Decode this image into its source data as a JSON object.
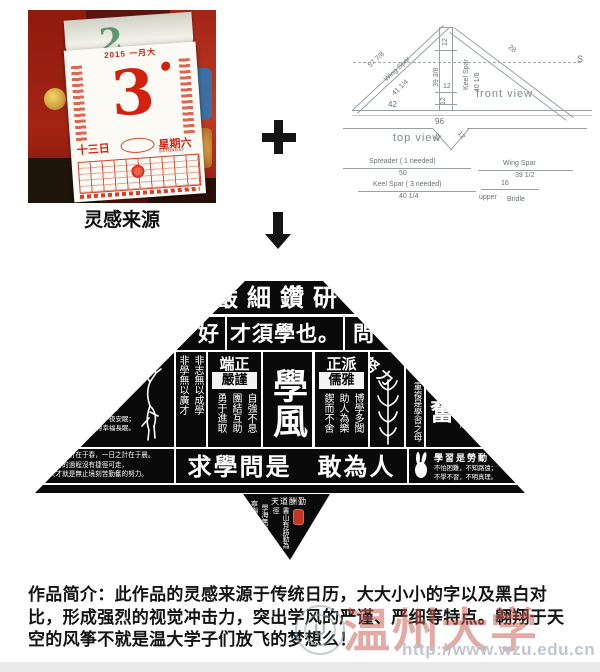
{
  "inspiration": {
    "label": "灵感来源",
    "calendar": {
      "prev_number": "2",
      "year": "2015",
      "month": "一月大",
      "day": "3",
      "day_cn": "十三日",
      "weekday_cn": "星期六",
      "weekday_en": "SATURDAY"
    }
  },
  "diagram": {
    "front_view_label": "front view",
    "top_view_label": "top view",
    "dims": {
      "wing_outer": "57 7/8",
      "wing_spar": "Wing Spar",
      "wing_inner": "41 1/4",
      "right_spar": "28",
      "spreader_end": "S",
      "keel_seg_top": "12",
      "keel_left": "39 3/8",
      "keel_label": "Keel Spar",
      "keel_right": "40 1/8",
      "keel_seg_mid": "12",
      "keel_seg_low": "12",
      "base_left": "42",
      "base_full": "96",
      "tv_left": "12",
      "tv_right": "12"
    },
    "parts": {
      "spreader_name": "Spreader ( 1 needed)",
      "spreader_len": "50",
      "keel_name": "Keel Spar ( 3 needed)",
      "keel_len": "40 1/4",
      "wing_name": "Wing Spar",
      "wing_len": "39 1/2",
      "bridle_len": "16",
      "bridle_upper": "upper",
      "bridle_label": "Bridle"
    }
  },
  "kite": {
    "row1": "嚴細鑽研",
    "row2_left": "好",
    "row2_center": "才須學也。",
    "row2_right": "問",
    "qin_big": "勤",
    "qin_line1": "勤勞一日，可得一夜安眠；",
    "qin_line2": "勤勞一生，可得幸福長眠。",
    "col_right": "非志無以成學",
    "col_left": "非學無以廣才",
    "duan_header": "端正",
    "duan_box": "嚴謹",
    "duan_cols": [
      "自強不息",
      "團結互助",
      "勇于進取"
    ],
    "center_big": "學風",
    "zheng_header": "正派",
    "zheng_box": "儒雅",
    "zheng_cols": [
      "博學多聞",
      "助人為樂",
      "鍥而不舍"
    ],
    "nuli": "努力",
    "chongfu": "重複是學習之母",
    "fen_big": "奮",
    "fen_line1": "用心去學，",
    "fen_line2": "你就是赢家。",
    "lefttip_line1": "一年之計在于春，一日之計在于晨。",
    "lefttip_line2": "學習的過程沒有捷徑可走，",
    "lefttip_line3": "天才就是無止境刻苦勤奮的努力。",
    "row4_center": "求學問是　敢為人先",
    "righttip_header": "學習是勞動",
    "righttip_line1": "不怕困難，不知路遠；",
    "righttip_line2": "不學不習，不明真理。",
    "tail_horiz": "天道酬勤",
    "tail_cols": [
      "書山有路勤為徑",
      "學海無涯苦作舟",
      "寧靜致遠"
    ]
  },
  "description": "作品简介：此作品的灵感来源于传统日历，大大小小的字以及黑白对比，形成强烈的视觉冲击力，突出学风的严谨、严细等特点。翱翔于天空的风筝不就是温大学子们放飞的梦想么！",
  "watermark": {
    "university": "温州大学",
    "url": "http://www.wzu.edu.cn",
    "logo_letter": "U"
  }
}
